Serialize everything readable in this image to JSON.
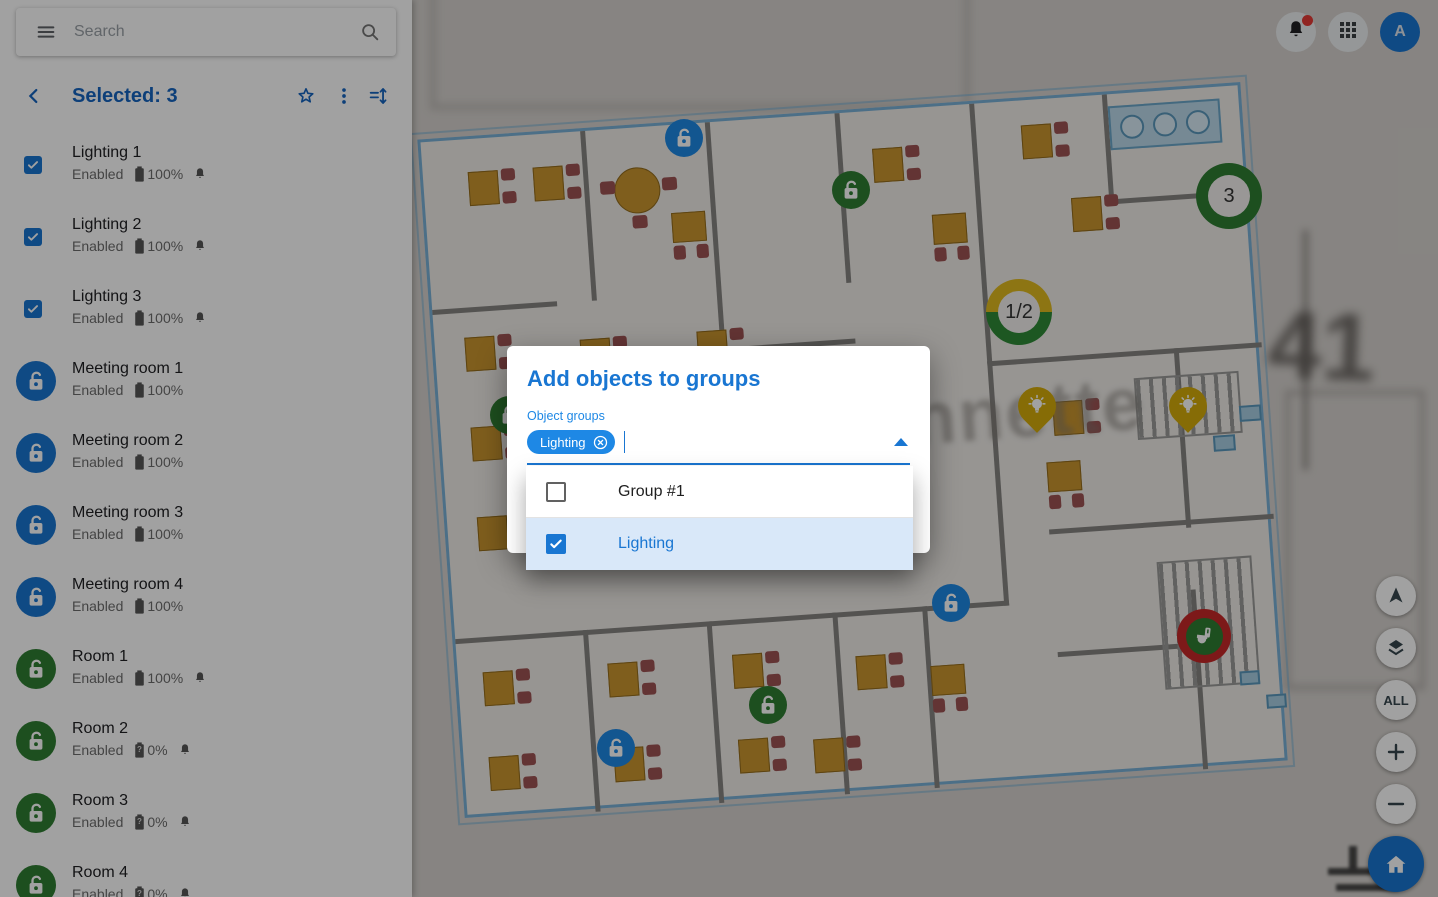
{
  "topbar": {
    "search": {
      "placeholder": "Search"
    },
    "notifications": {
      "has_badge": true
    },
    "avatar": {
      "initial": "A"
    }
  },
  "sidebar": {
    "header": {
      "title": "Selected: 3"
    },
    "items": [
      {
        "name": "Lighting 1",
        "control": "checkbox",
        "checked": true,
        "status": "Enabled",
        "battery": "100%",
        "battery_unknown": false,
        "bell": true
      },
      {
        "name": "Lighting 2",
        "control": "checkbox",
        "checked": true,
        "status": "Enabled",
        "battery": "100%",
        "battery_unknown": false,
        "bell": true
      },
      {
        "name": "Lighting 3",
        "control": "checkbox",
        "checked": true,
        "status": "Enabled",
        "battery": "100%",
        "battery_unknown": false,
        "bell": true
      },
      {
        "name": "Meeting room 1",
        "control": "lock",
        "color": "blue",
        "status": "Enabled",
        "battery": "100%",
        "battery_unknown": false,
        "bell": false
      },
      {
        "name": "Meeting room 2",
        "control": "lock",
        "color": "blue",
        "status": "Enabled",
        "battery": "100%",
        "battery_unknown": false,
        "bell": false
      },
      {
        "name": "Meeting room 3",
        "control": "lock",
        "color": "blue",
        "status": "Enabled",
        "battery": "100%",
        "battery_unknown": false,
        "bell": false
      },
      {
        "name": "Meeting room 4",
        "control": "lock",
        "color": "blue",
        "status": "Enabled",
        "battery": "100%",
        "battery_unknown": false,
        "bell": false
      },
      {
        "name": "Room 1",
        "control": "lock",
        "color": "green",
        "status": "Enabled",
        "battery": "100%",
        "battery_unknown": false,
        "bell": true
      },
      {
        "name": "Room 2",
        "control": "lock",
        "color": "green",
        "status": "Enabled",
        "battery": "0%",
        "battery_unknown": true,
        "bell": true
      },
      {
        "name": "Room 3",
        "control": "lock",
        "color": "green",
        "status": "Enabled",
        "battery": "0%",
        "battery_unknown": true,
        "bell": true
      },
      {
        "name": "Room 4",
        "control": "lock",
        "color": "green",
        "status": "Enabled",
        "battery": "0%",
        "battery_unknown": true,
        "bell": true
      }
    ]
  },
  "dialog": {
    "title": "Add objects to groups",
    "field_label": "Object groups",
    "chips": [
      {
        "label": "Lighting"
      }
    ],
    "options": [
      {
        "label": "Group #1",
        "checked": false,
        "highlighted": false
      },
      {
        "label": "Lighting",
        "checked": true,
        "highlighted": true
      }
    ]
  },
  "map": {
    "labels": [
      {
        "text": "nnette"
      },
      {
        "text": "41"
      }
    ],
    "markers": [
      {
        "type": "lock",
        "color": "blue",
        "x": 684,
        "y": 138
      },
      {
        "type": "lock",
        "color": "green",
        "x": 851,
        "y": 190
      },
      {
        "type": "cluster",
        "label": "3",
        "ring": "green",
        "x": 1229,
        "y": 196
      },
      {
        "type": "cluster",
        "label": "1/2",
        "ring": "half",
        "x": 1019,
        "y": 312
      },
      {
        "type": "pin-bulb",
        "x": 1037,
        "y": 408
      },
      {
        "type": "pin-bulb",
        "x": 1188,
        "y": 408
      },
      {
        "type": "lock",
        "color": "green",
        "x": 509,
        "y": 415
      },
      {
        "type": "lock",
        "color": "blue",
        "x": 951,
        "y": 603
      },
      {
        "type": "toilet",
        "x": 1204,
        "y": 636
      },
      {
        "type": "lock",
        "color": "green",
        "x": 768,
        "y": 705
      },
      {
        "type": "lock",
        "color": "blue",
        "x": 616,
        "y": 748
      }
    ]
  },
  "controls": [
    {
      "icon": "navigation-arrow"
    },
    {
      "icon": "layers"
    },
    {
      "label": "ALL"
    },
    {
      "icon": "plus"
    },
    {
      "icon": "minus"
    },
    {
      "icon": "home",
      "primary": true
    }
  ],
  "colors": {
    "accent": "#1976d2",
    "accent_dark": "#1565c0",
    "green": "#2e7d32",
    "chip": "#1e88e5",
    "highlight": "#d9e8f9",
    "badge_red": "#e53935",
    "marker_red": "#c62828",
    "pin_yellow": "#d4ac0b",
    "ring_yellow": "#e0b91f"
  }
}
